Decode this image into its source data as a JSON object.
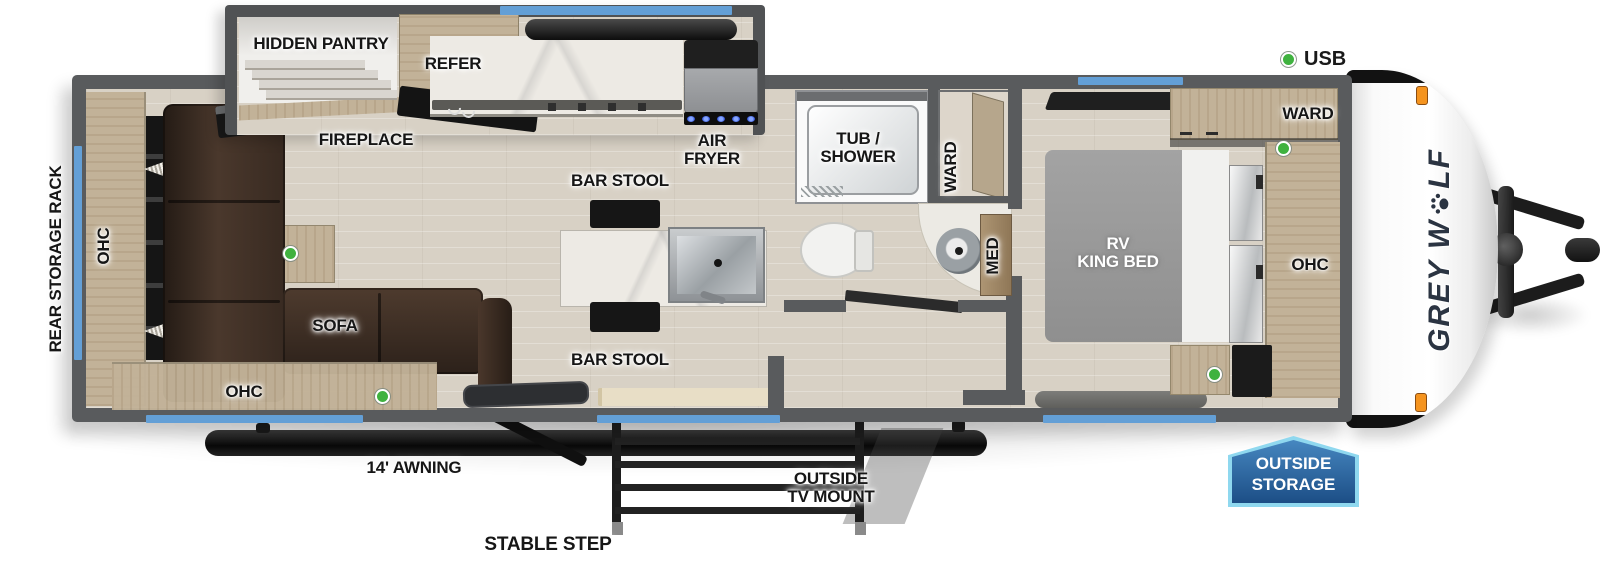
{
  "legend": {
    "usb": "USB"
  },
  "exterior": {
    "rear_storage_rack": "REAR STORAGE RACK",
    "awning": "14' AWNING",
    "stable_step": "STABLE STEP",
    "tv_mount_line1": "OUTSIDE",
    "tv_mount_line2": "TV MOUNT",
    "badge_line1": "OUTSIDE",
    "badge_line2": "STORAGE",
    "brand_prefix": "GREY W",
    "brand_suffix": "LF"
  },
  "living": {
    "ohc_left": "OHC",
    "ohc_bottom": "OHC",
    "sofa": "SOFA",
    "fireplace": "FIREPLACE"
  },
  "kitchen": {
    "hidden_pantry": "HIDDEN PANTRY",
    "refer": "REFER",
    "air_fryer_line1": "AIR",
    "air_fryer_line2": "FRYER",
    "bar_stool_top": "BAR STOOL",
    "bar_stool_bottom": "BAR STOOL"
  },
  "bathroom": {
    "tub_line1": "TUB /",
    "tub_line2": "SHOWER",
    "ward": "WARD",
    "med": "MED"
  },
  "bedroom": {
    "bed_line1": "RV",
    "bed_line2": "KING BED",
    "ward": "WARD",
    "ohc": "OHC"
  },
  "colors": {
    "window_blue": "#639fd6",
    "usb_green": "#3fb23f",
    "badge_border": "#8fd8ef",
    "badge_blue_top": "#4687c0",
    "badge_blue_bottom": "#1c4e86",
    "flame_orange": "#ff8c1a",
    "wall_gray": "#595b5d"
  }
}
